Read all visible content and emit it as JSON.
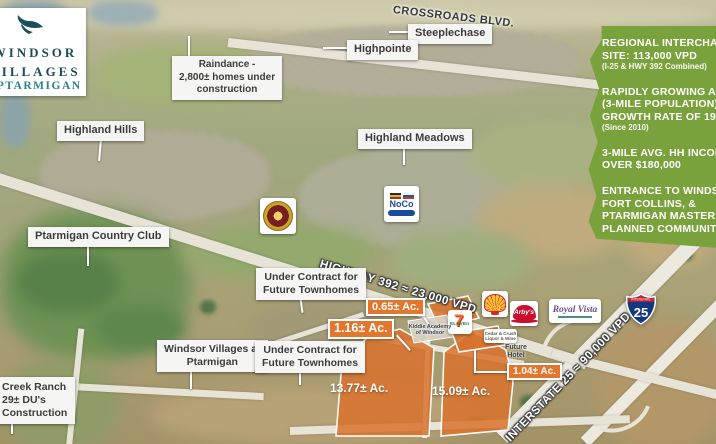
{
  "logo": {
    "icon": "ptarmigan-bird-icon",
    "line1": "WINDSOR",
    "line2": "VILLAGES",
    "line3": "AT PTARMIGAN"
  },
  "road_labels": {
    "crossroads_blvd": "CROSSROADS BLVD.",
    "highway_392": "HIGHWAY 392 ≈ 23,000 VPD",
    "interstate_25": "INTERSTATE 25 ≈ 90,000 VPD",
    "i25_shield_top": "INTERSTATE",
    "i25_shield_number": "25"
  },
  "neighborhood_labels": [
    {
      "id": "steeplechase",
      "lines": [
        "Steeplechase"
      ]
    },
    {
      "id": "highpointe",
      "lines": [
        "Highpointe"
      ]
    },
    {
      "id": "raindance",
      "lines": [
        "Raindance -",
        "2,800± homes under",
        "construction"
      ]
    },
    {
      "id": "highland-hills",
      "lines": [
        "Highland Hills"
      ]
    },
    {
      "id": "highland-meadows",
      "lines": [
        "Highland Meadows"
      ]
    },
    {
      "id": "ptarmigan-country-club",
      "lines": [
        "Ptarmigan Country Club"
      ]
    },
    {
      "id": "under-contract-north",
      "lines": [
        "Under Contract for",
        "Future Townhomes"
      ]
    },
    {
      "id": "windsor-villages-at-ptarmigan",
      "lines": [
        "Windsor Villages at",
        "Ptarmigan"
      ]
    },
    {
      "id": "under-contract-south",
      "lines": [
        "Under Contract for",
        "Future Townhomes"
      ]
    },
    {
      "id": "creek-ranch",
      "lines": [
        "Creek Ranch",
        "29± DU's",
        "Construction"
      ]
    }
  ],
  "parcels": {
    "chips": [
      {
        "label": "0.65± Ac."
      },
      {
        "label": "1.16± Ac."
      },
      {
        "label": "1.04± Ac."
      }
    ],
    "areas": [
      {
        "label": "13.77± Ac."
      },
      {
        "label": "15.09± Ac."
      }
    ]
  },
  "pois": {
    "seven_eleven_glyph": "7",
    "seven_eleven_word": "ELEVEn",
    "arbys": "Arby's",
    "royal_vista": "Royal Vista",
    "noco": "NoCo",
    "shell_icon": "shell-pecten-icon",
    "fire_emblem_icon": "circular-seal-icon",
    "kiddie_academy": {
      "lines": [
        "Kiddie Academy",
        "of Windsor"
      ]
    },
    "future_hotel": {
      "lines": [
        "Future",
        "Hotel"
      ]
    },
    "liquor_store": {
      "lines": [
        "Cedar & Crush",
        "Liquor & Wine"
      ]
    }
  },
  "info_panel": {
    "background_color": "#7aa23c",
    "groups": [
      {
        "lines": [
          "REGIONAL INTERCHANGE",
          "SITE: 113,000 VPD"
        ],
        "sub": "(I-25 & HWY 392 Combined)"
      },
      {
        "lines": [
          "RAPIDLY GROWING AREA",
          "(3-MILE POPULATION)",
          "GROWTH RATE OF 19%"
        ],
        "sub": "(Since 2010)"
      },
      {
        "lines": [
          "3-MILE AVG. HH INCOME",
          "OVER $180,000"
        ]
      },
      {
        "lines": [
          "ENTRANCE TO WINDSOR,",
          "FORT COLLINS, &",
          "PTARMIGAN MASTER",
          "PLANNED COMMUNITY"
        ]
      }
    ]
  },
  "colors": {
    "parcel_orange": "#d9722e",
    "chip_orange": "#e2762c",
    "panel_green": "#7aa23c",
    "logo_teal": "#1d4a57",
    "logo_teal_light": "#2d7f93"
  }
}
